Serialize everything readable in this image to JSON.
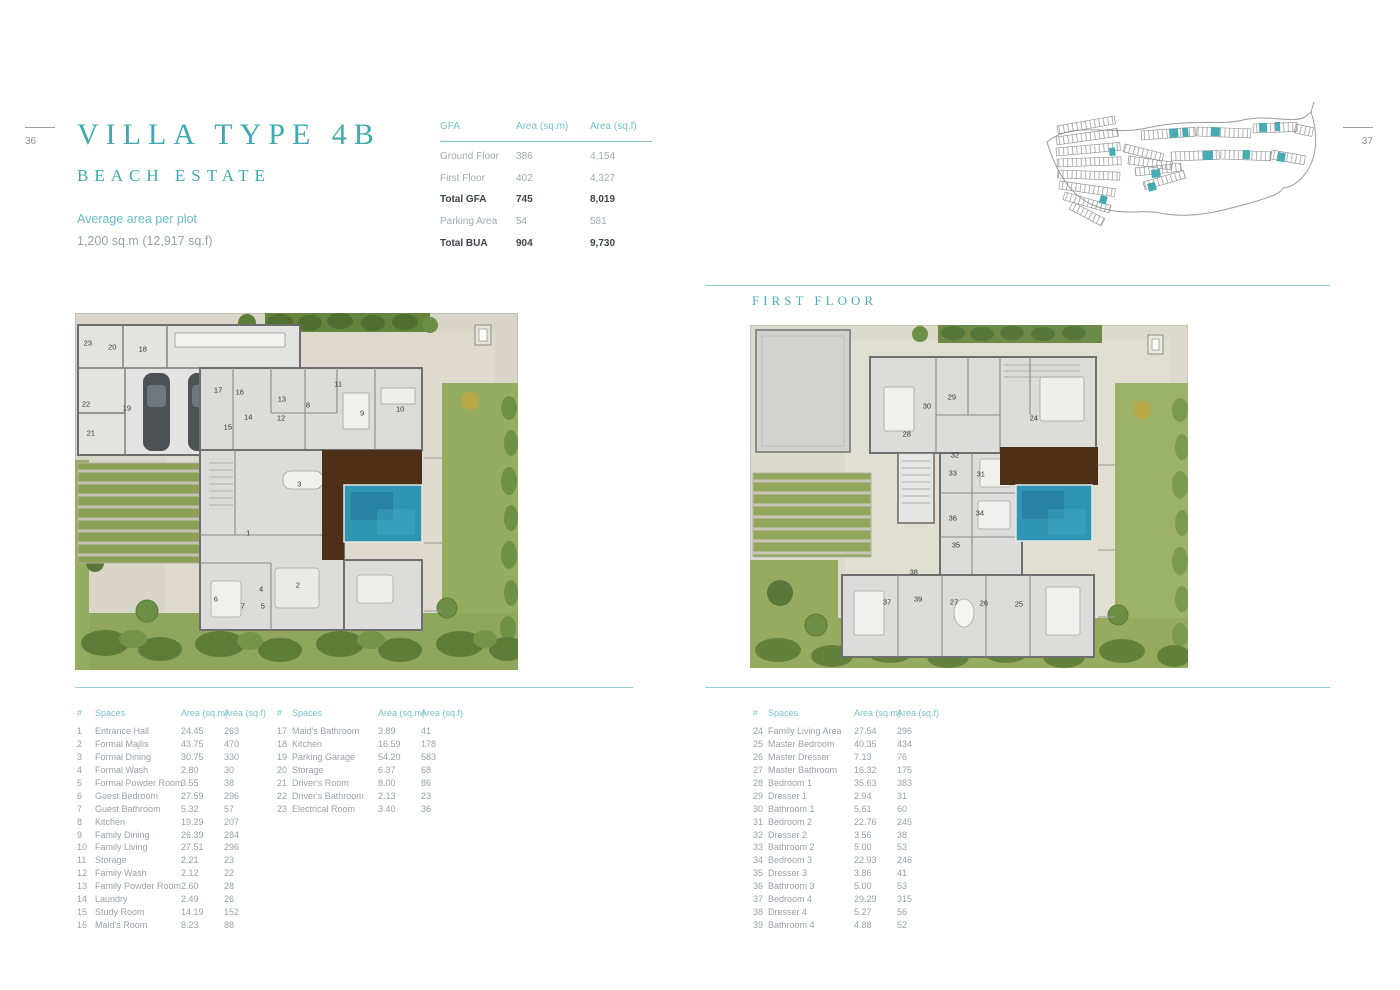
{
  "page": {
    "left_page_number": "36",
    "right_page_number": "37",
    "title": "VILLA TYPE 4B",
    "subtitle": "BEACH ESTATE",
    "plot_label": "Average area per plot",
    "plot_value": "1,200 sq.m (12,917 sq.f)",
    "first_floor_label": "FIRST FLOOR"
  },
  "gfa_table": {
    "headers": [
      "GFA",
      "Area (sq.m)",
      "Area (sq.f)"
    ],
    "rows": [
      {
        "label": "Ground Floor",
        "sqm": "386",
        "sqf": "4,154",
        "bold": false
      },
      {
        "label": "First Floor",
        "sqm": "402",
        "sqf": "4,327",
        "bold": false
      },
      {
        "label": "Total GFA",
        "sqm": "745",
        "sqf": "8,019",
        "bold": true
      },
      {
        "label": "Parking Area",
        "sqm": "54",
        "sqf": "581",
        "bold": false
      },
      {
        "label": "Total BUA",
        "sqm": "904",
        "sqf": "9,730",
        "bold": true
      }
    ]
  },
  "spaces_headers": {
    "num": "#",
    "name": "Spaces",
    "sqm": "Area (sq.m)",
    "sqf": "Area (sq.f)"
  },
  "spaces_left": [
    {
      "num": "1",
      "name": "Entrance Hall",
      "sqm": "24.45",
      "sqf": "263"
    },
    {
      "num": "2",
      "name": "Formal Majlis",
      "sqm": "43.75",
      "sqf": "470"
    },
    {
      "num": "3",
      "name": "Formal Dining",
      "sqm": "30.75",
      "sqf": "330"
    },
    {
      "num": "4",
      "name": "Formal Wash",
      "sqm": "2.80",
      "sqf": "30"
    },
    {
      "num": "5",
      "name": "Formal Powder Room",
      "sqm": "3.55",
      "sqf": "38"
    },
    {
      "num": "6",
      "name": "Guest Bedroom",
      "sqm": "27.59",
      "sqf": "296"
    },
    {
      "num": "7",
      "name": "Guest Bathroom",
      "sqm": "5.32",
      "sqf": "57"
    },
    {
      "num": "8",
      "name": "Kitchen",
      "sqm": "19.29",
      "sqf": "207"
    },
    {
      "num": "9",
      "name": "Family Dining",
      "sqm": "26.39",
      "sqf": "284"
    },
    {
      "num": "10",
      "name": "Family Living",
      "sqm": "27.51",
      "sqf": "296"
    },
    {
      "num": "11",
      "name": "Storage",
      "sqm": "2.21",
      "sqf": "23"
    },
    {
      "num": "12",
      "name": "Family Wash",
      "sqm": "2.12",
      "sqf": "22"
    },
    {
      "num": "13",
      "name": "Family Powder Room",
      "sqm": "2.60",
      "sqf": "28"
    },
    {
      "num": "14",
      "name": "Laundry",
      "sqm": "2.49",
      "sqf": "26"
    },
    {
      "num": "15",
      "name": "Study Room",
      "sqm": "14.19",
      "sqf": "152"
    },
    {
      "num": "16",
      "name": "Maid's Room",
      "sqm": "8.23",
      "sqf": "88"
    }
  ],
  "spaces_middle": [
    {
      "num": "17",
      "name": "Maid's Bathroom",
      "sqm": "3.89",
      "sqf": "41"
    },
    {
      "num": "18",
      "name": "Kitchen",
      "sqm": "16.59",
      "sqf": "178"
    },
    {
      "num": "19",
      "name": "Parking Garage",
      "sqm": "54.20",
      "sqf": "583"
    },
    {
      "num": "20",
      "name": "Storage",
      "sqm": "6.37",
      "sqf": "68"
    },
    {
      "num": "21",
      "name": "Driver's Room",
      "sqm": "8.00",
      "sqf": "86"
    },
    {
      "num": "22",
      "name": "Driver's Bathroom",
      "sqm": "2.13",
      "sqf": "23"
    },
    {
      "num": "23",
      "name": "Electrical Room",
      "sqm": "3.40",
      "sqf": "36"
    }
  ],
  "spaces_right": [
    {
      "num": "24",
      "name": "Family Living Area",
      "sqm": "27.54",
      "sqf": "296"
    },
    {
      "num": "25",
      "name": "Master Bedroom",
      "sqm": "40.35",
      "sqf": "434"
    },
    {
      "num": "26",
      "name": "Master Dresser",
      "sqm": "7.13",
      "sqf": "76"
    },
    {
      "num": "27",
      "name": "Master Bathroom",
      "sqm": "16.32",
      "sqf": "175"
    },
    {
      "num": "28",
      "name": "Bedroom 1",
      "sqm": "35.63",
      "sqf": "383"
    },
    {
      "num": "29",
      "name": "Dresser 1",
      "sqm": "2.94",
      "sqf": "31"
    },
    {
      "num": "30",
      "name": "Bathroom 1",
      "sqm": "5.61",
      "sqf": "60"
    },
    {
      "num": "31",
      "name": "Bedroom 2",
      "sqm": "22.76",
      "sqf": "245"
    },
    {
      "num": "32",
      "name": "Dresser 2",
      "sqm": "3.56",
      "sqf": "38"
    },
    {
      "num": "33",
      "name": "Bathroom 2",
      "sqm": "5.00",
      "sqf": "53"
    },
    {
      "num": "34",
      "name": "Bedroom 3",
      "sqm": "22.93",
      "sqf": "246"
    },
    {
      "num": "35",
      "name": "Dresser 3",
      "sqm": "3.86",
      "sqf": "41"
    },
    {
      "num": "36",
      "name": "Bathroom 3",
      "sqm": "5.00",
      "sqf": "53"
    },
    {
      "num": "37",
      "name": "Bedroom 4",
      "sqm": "29.29",
      "sqf": "315"
    },
    {
      "num": "38",
      "name": "Dresser 4",
      "sqm": "5.27",
      "sqf": "56"
    },
    {
      "num": "39",
      "name": "Bathroom 4",
      "sqm": "4.88",
      "sqf": "52"
    }
  ],
  "ground_plan": {
    "rooms": [
      {
        "n": "1",
        "x": 39.1,
        "y": 61.6
      },
      {
        "n": "2",
        "x": 50.3,
        "y": 76.2
      },
      {
        "n": "3",
        "x": 50.6,
        "y": 47.9
      },
      {
        "n": "4",
        "x": 42.0,
        "y": 77.3
      },
      {
        "n": "5",
        "x": 42.4,
        "y": 82.1
      },
      {
        "n": "6",
        "x": 31.8,
        "y": 80.1
      },
      {
        "n": "7",
        "x": 37.9,
        "y": 82.1
      },
      {
        "n": "8",
        "x": 52.6,
        "y": 25.8
      },
      {
        "n": "9",
        "x": 64.8,
        "y": 28.0
      },
      {
        "n": "10",
        "x": 73.4,
        "y": 26.9
      },
      {
        "n": "11",
        "x": 59.4,
        "y": 19.9
      },
      {
        "n": "12",
        "x": 46.5,
        "y": 29.4
      },
      {
        "n": "13",
        "x": 46.7,
        "y": 24.1
      },
      {
        "n": "14",
        "x": 39.1,
        "y": 29.1
      },
      {
        "n": "15",
        "x": 34.5,
        "y": 31.9
      },
      {
        "n": "16",
        "x": 37.2,
        "y": 22.1
      },
      {
        "n": "17",
        "x": 32.3,
        "y": 21.6
      },
      {
        "n": "18",
        "x": 15.3,
        "y": 10.1
      },
      {
        "n": "19",
        "x": 11.7,
        "y": 26.6
      },
      {
        "n": "20",
        "x": 8.4,
        "y": 9.5
      },
      {
        "n": "21",
        "x": 3.6,
        "y": 33.6
      },
      {
        "n": "22",
        "x": 2.5,
        "y": 25.5
      },
      {
        "n": "23",
        "x": 2.9,
        "y": 8.4
      }
    ]
  },
  "first_floor_plan": {
    "rooms": [
      {
        "n": "24",
        "x": 64.8,
        "y": 27.1
      },
      {
        "n": "25",
        "x": 61.4,
        "y": 81.3
      },
      {
        "n": "26",
        "x": 53.4,
        "y": 81.0
      },
      {
        "n": "27",
        "x": 46.6,
        "y": 80.8
      },
      {
        "n": "28",
        "x": 35.8,
        "y": 31.8
      },
      {
        "n": "29",
        "x": 46.1,
        "y": 21.0
      },
      {
        "n": "30",
        "x": 40.4,
        "y": 23.6
      },
      {
        "n": "31",
        "x": 52.7,
        "y": 43.4
      },
      {
        "n": "32",
        "x": 46.8,
        "y": 37.9
      },
      {
        "n": "33",
        "x": 46.3,
        "y": 43.1
      },
      {
        "n": "34",
        "x": 52.5,
        "y": 54.8
      },
      {
        "n": "35",
        "x": 47.0,
        "y": 64.1
      },
      {
        "n": "36",
        "x": 46.3,
        "y": 56.3
      },
      {
        "n": "37",
        "x": 31.3,
        "y": 80.8
      },
      {
        "n": "38",
        "x": 37.4,
        "y": 72.0
      },
      {
        "n": "39",
        "x": 38.4,
        "y": 79.9
      }
    ]
  },
  "colors": {
    "teal": "#3fa9b1",
    "teal_light": "#74c4cb",
    "divider": "#96ced4",
    "text_gray": "#9ba0a8",
    "text_dark": "#3f434a",
    "lawn": "#94ad61",
    "hedge": "#64843d",
    "pool": "#2e95b3",
    "deck": "#4e3019",
    "building": "#dcdcda",
    "plot": "#d9d6c9"
  }
}
